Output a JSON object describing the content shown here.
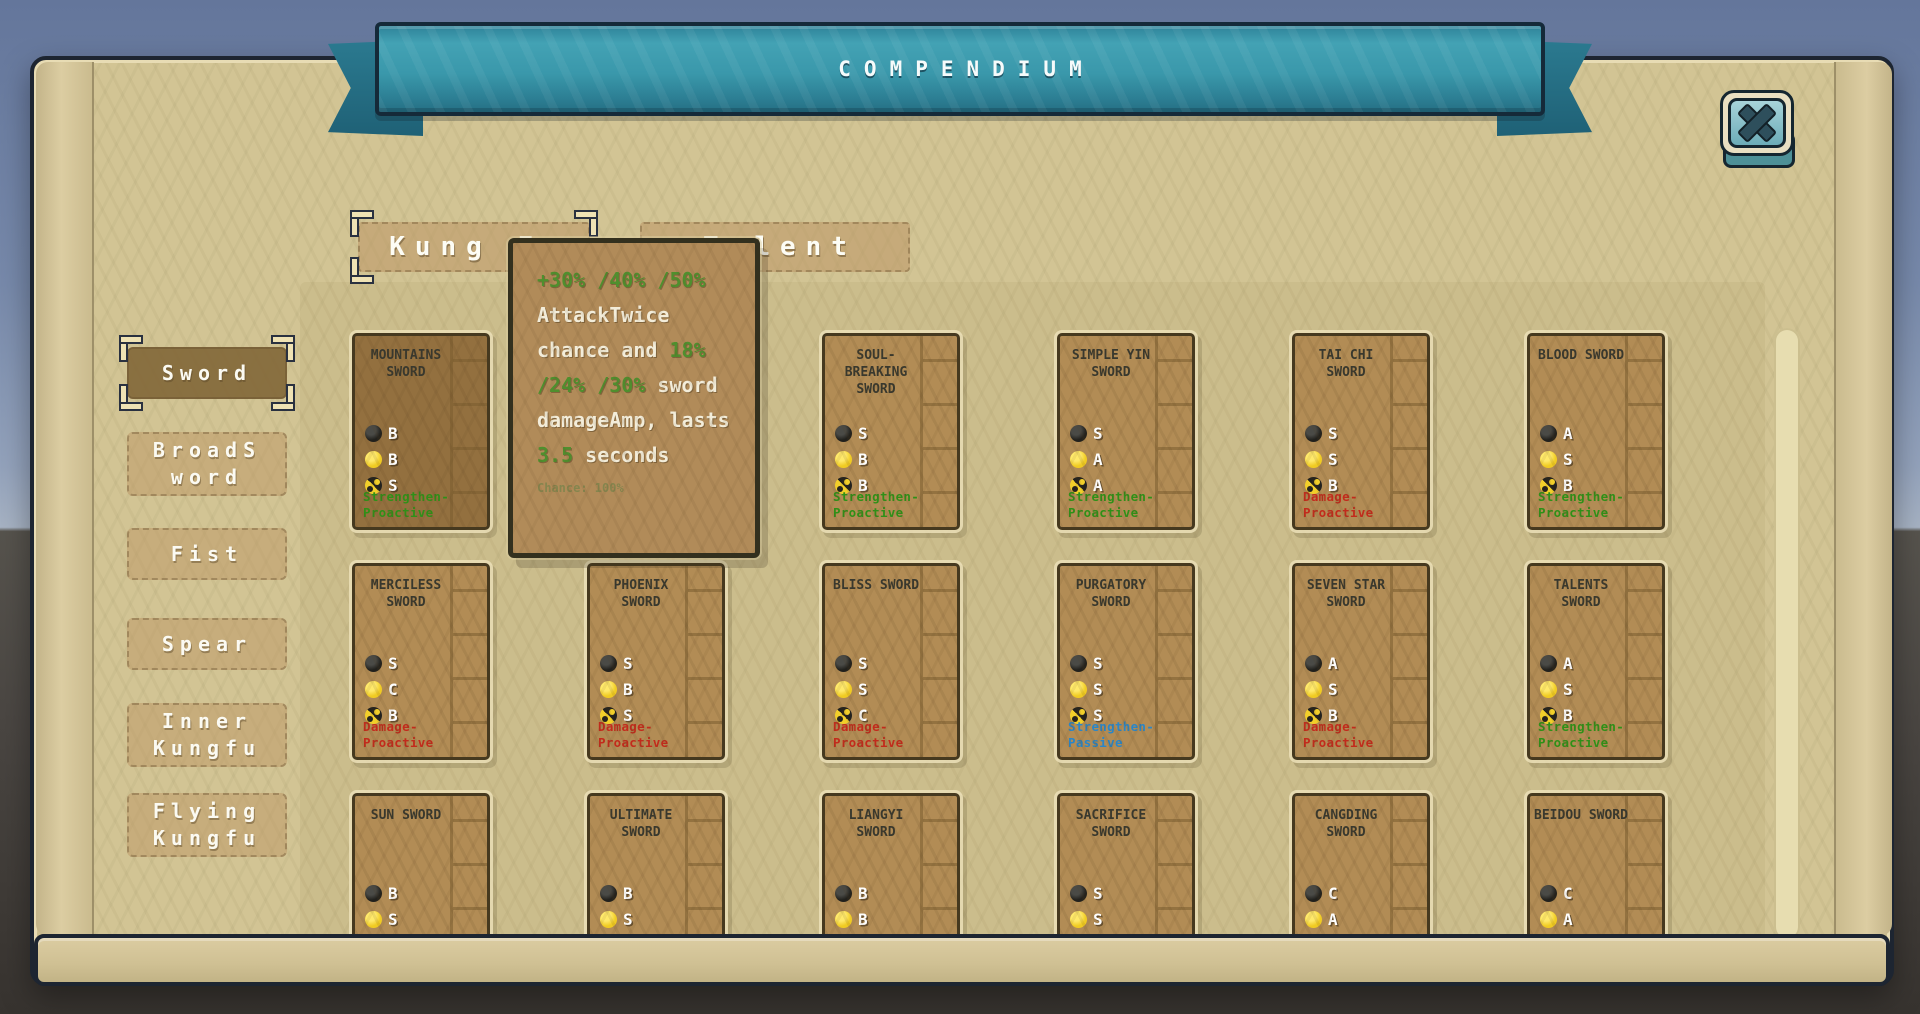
{
  "banner": {
    "title": "COMPENDIUM"
  },
  "tabs": [
    {
      "label": "Kung Fu",
      "selected": true
    },
    {
      "label": "Talent",
      "selected": false
    }
  ],
  "sidebar": {
    "items": [
      {
        "label": "Sword",
        "selected": true
      },
      {
        "label": "BroadSword",
        "selected": false
      },
      {
        "label": "Fist",
        "selected": false
      },
      {
        "label": "Spear",
        "selected": false
      },
      {
        "label": "Inner Kungfu",
        "selected": false
      },
      {
        "label": "Flying Kungfu",
        "selected": false
      }
    ]
  },
  "tooltip": {
    "segments": [
      {
        "text": "+30% /40% /50% ",
        "color": "green"
      },
      {
        "text": "AttackTwice chance and ",
        "color": "white"
      },
      {
        "text": "18% /24% /30%",
        "color": "green"
      },
      {
        "text": " sword damageAmp, lasts ",
        "color": "white"
      },
      {
        "text": "3.5",
        "color": "green"
      },
      {
        "text": " seconds",
        "color": "white"
      }
    ],
    "chance": "Chance: 100%"
  },
  "stat_icons": [
    "black-orb-icon",
    "yellow-orb-icon",
    "taichi-icon"
  ],
  "type_colors": {
    "Strengthen-Proactive": "#2f9018",
    "Damage-Proactive": "#c22b1c",
    "Strengthen-Passive": "#2a86c8"
  },
  "colors": {
    "banner_teal": "#3b93a6",
    "panel_parchment": "#d2c494",
    "card_brown": "#b28c55",
    "card_hover_brown": "#93703f",
    "stat_black": "#23221e",
    "stat_yellow": "#f2cf2a",
    "tooltip_bg": "#b18b59",
    "tooltip_green": "#4f8f2e",
    "chance_olive": "#85854e"
  },
  "cards": {
    "grid": [
      [
        {
          "name": "MOUNTAINS SWORD",
          "stats": [
            "B",
            "B",
            "S"
          ],
          "type": "Strengthen-Proactive",
          "hovered": true
        },
        null,
        {
          "name": "SOUL-BREAKING SWORD",
          "stats": [
            "S",
            "B",
            "B"
          ],
          "type": "Strengthen-Proactive"
        },
        {
          "name": "SIMPLE YIN SWORD",
          "stats": [
            "S",
            "A",
            "A"
          ],
          "type": "Strengthen-Proactive"
        },
        {
          "name": "TAI CHI SWORD",
          "stats": [
            "S",
            "S",
            "B"
          ],
          "type": "Damage-Proactive"
        },
        {
          "name": "BLOOD SWORD",
          "stats": [
            "A",
            "S",
            "B"
          ],
          "type": "Strengthen-Proactive"
        }
      ],
      [
        {
          "name": "MERCILESS SWORD",
          "stats": [
            "S",
            "C",
            "B"
          ],
          "type": "Damage-Proactive"
        },
        {
          "name": "PHOENIX SWORD",
          "stats": [
            "S",
            "B",
            "S"
          ],
          "type": "Damage-Proactive"
        },
        {
          "name": "BLISS SWORD",
          "stats": [
            "S",
            "S",
            "C"
          ],
          "type": "Damage-Proactive"
        },
        {
          "name": "PURGATORY SWORD",
          "stats": [
            "S",
            "S",
            "S"
          ],
          "type": "Strengthen-Passive"
        },
        {
          "name": "SEVEN STAR SWORD",
          "stats": [
            "A",
            "S",
            "B"
          ],
          "type": "Damage-Proactive"
        },
        {
          "name": "TALENTS SWORD",
          "stats": [
            "A",
            "S",
            "B"
          ],
          "type": "Strengthen-Proactive"
        }
      ],
      [
        {
          "name": "SUN SWORD",
          "stats": [
            "B",
            "S"
          ]
        },
        {
          "name": "ULTIMATE SWORD",
          "stats": [
            "B",
            "S"
          ]
        },
        {
          "name": "LIANGYI SWORD",
          "stats": [
            "B",
            "B"
          ]
        },
        {
          "name": "SACRIFICE SWORD",
          "stats": [
            "S",
            "S"
          ]
        },
        {
          "name": "CANGDING SWORD",
          "stats": [
            "C",
            "A"
          ]
        },
        {
          "name": "BEIDOU SWORD",
          "stats": [
            "C",
            "A"
          ]
        }
      ]
    ]
  }
}
